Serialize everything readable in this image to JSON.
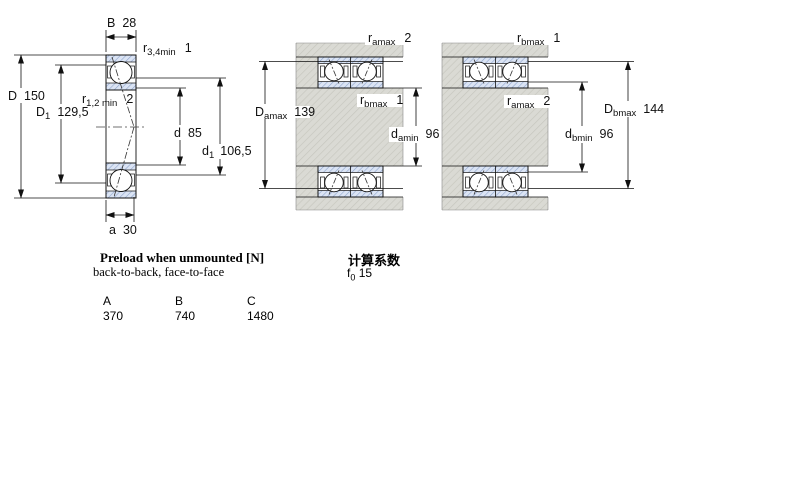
{
  "left_diagram": {
    "B": {
      "base": "B",
      "value": "28"
    },
    "r34": {
      "base": "r",
      "sub": "3,4min",
      "value": "1"
    },
    "D": {
      "base": "D",
      "value": "150"
    },
    "D1": {
      "base": "D",
      "sub": "1",
      "value": "129,5"
    },
    "r12": {
      "base": "r",
      "sub": "1,2 min",
      "value": "2"
    },
    "d": {
      "base": "d",
      "value": "85"
    },
    "d1": {
      "base": "d",
      "sub": "1",
      "value": "106,5"
    },
    "a": {
      "base": "a",
      "value": "30"
    }
  },
  "middle_diagram": {
    "ramax": {
      "base": "r",
      "sub": "amax",
      "value": "2"
    },
    "rbmax": {
      "base": "r",
      "sub": "bmax",
      "value": "1"
    },
    "Damax": {
      "base": "D",
      "sub": "amax",
      "value": "139"
    },
    "damin": {
      "base": "d",
      "sub": "amin",
      "value": "96"
    }
  },
  "right_diagram": {
    "rbmax": {
      "base": "r",
      "sub": "bmax",
      "value": "1"
    },
    "ramax": {
      "base": "r",
      "sub": "amax",
      "value": "2"
    },
    "Dbmax": {
      "base": "D",
      "sub": "bmax",
      "value": "144"
    },
    "dbmin": {
      "base": "d",
      "sub": "bmin",
      "value": "96"
    }
  },
  "preload": {
    "title": "Preload when unmounted [N]",
    "subtitle": "back-to-back, face-to-face",
    "columns": [
      "A",
      "B",
      "C"
    ],
    "values": [
      "370",
      "740",
      "1480"
    ]
  },
  "calculation": {
    "title": "计算系数",
    "factor": {
      "base": "f",
      "sub": "0",
      "value": "15"
    }
  },
  "colors": {
    "ring_hatch_bg": "#dbe4f4",
    "ring_hatch_line": "#8fa5cc",
    "steel_hatch_bg": "#dadad4",
    "steel_hatch_line": "#c6c6be",
    "line": "#111111"
  }
}
